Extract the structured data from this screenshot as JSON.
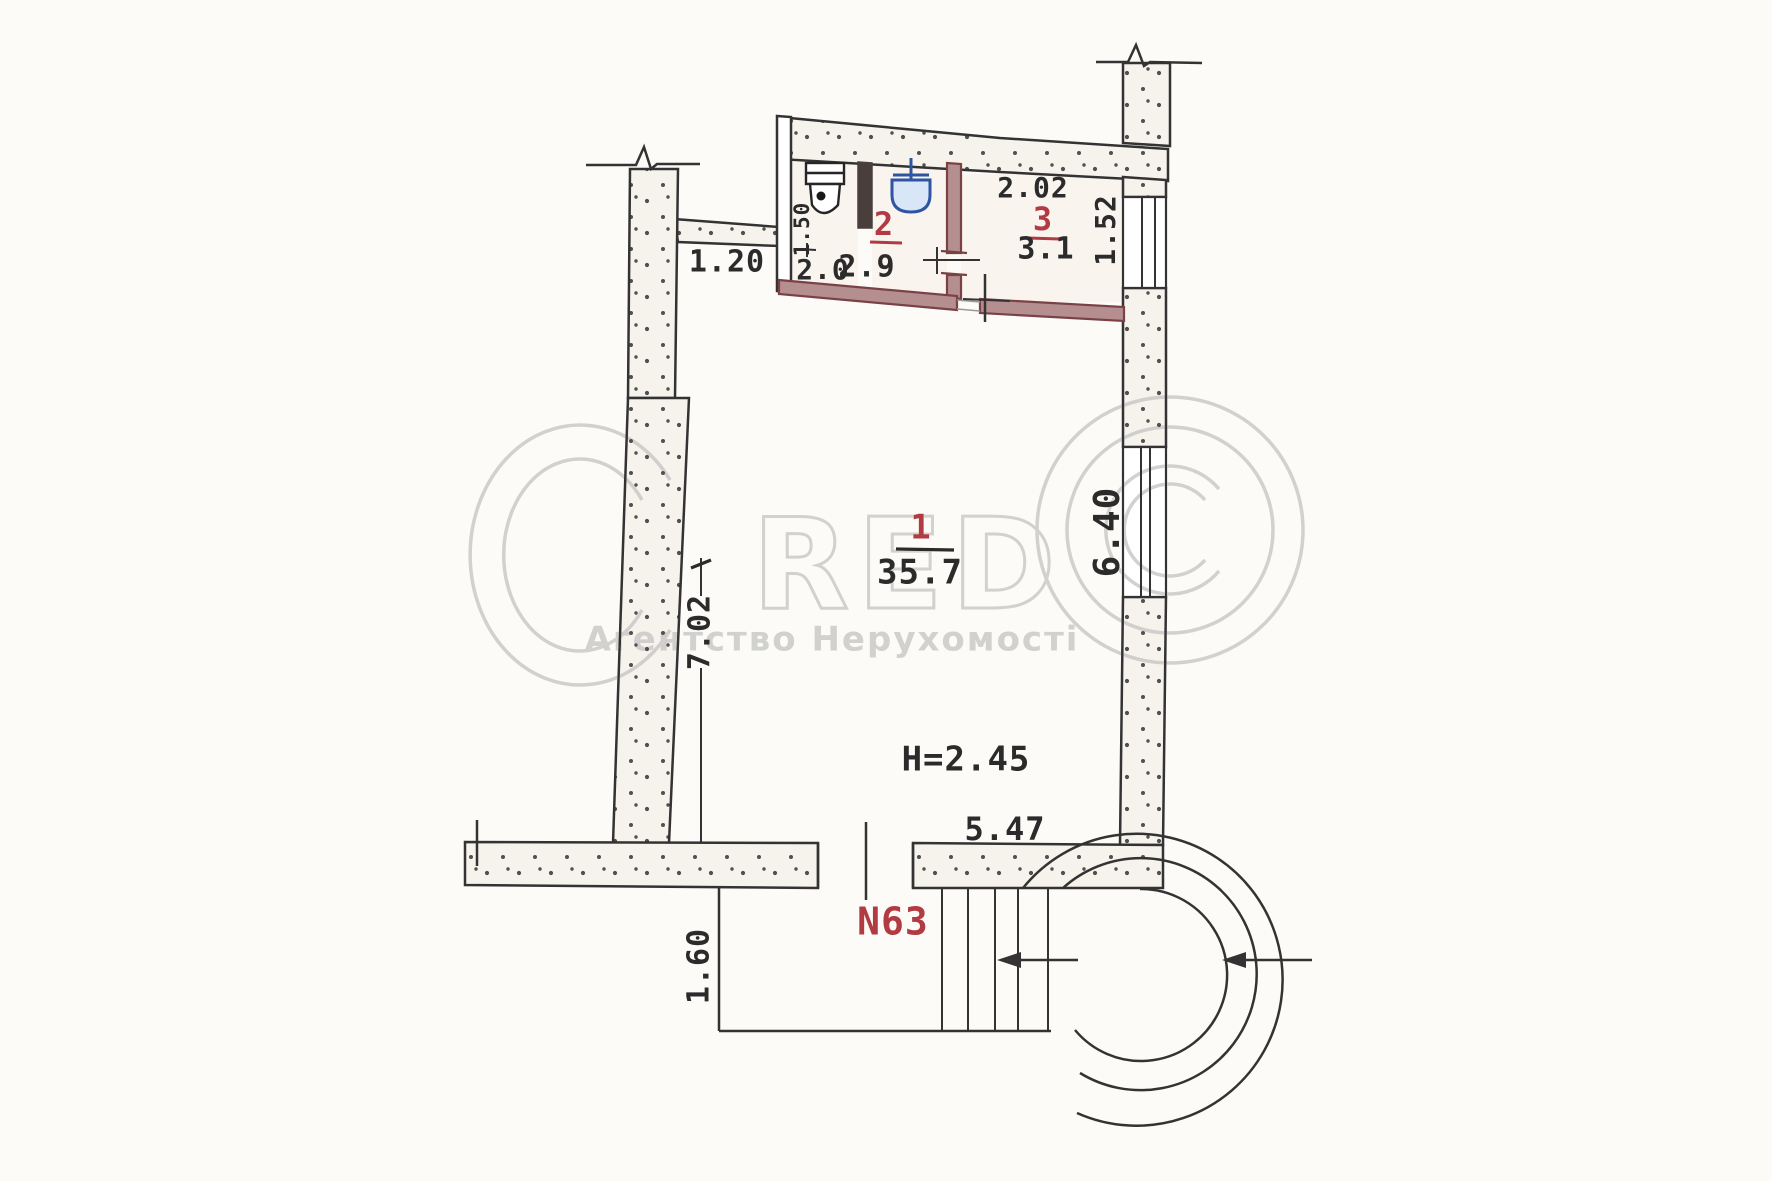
{
  "watermark": {
    "logo_text": "RED",
    "tagline": "Агентство Нерухомості"
  },
  "rooms": [
    {
      "number": "1",
      "area": "35.7"
    },
    {
      "number": "2",
      "area": "2.9"
    },
    {
      "number": "3",
      "area": "3.1"
    }
  ],
  "dimensions": {
    "corridor_width": "1.20",
    "wc_width": "2.0",
    "wc_depth": "1.50",
    "room3_width": "2.02",
    "room3_depth": "1.52",
    "room1_width": "5.47",
    "room1_depth_left": "7.02",
    "room1_depth_right": "6.40",
    "ceiling_height": "H=2.45",
    "porch_depth": "1.60"
  },
  "labels": {
    "unit_number": "N63"
  },
  "colors": {
    "paper": "#fcfbf8",
    "wall-line": "#333333",
    "wall-bg": "#f6f2ec",
    "stipple-dot": "#4f4f4f",
    "masonry-fill": "#b58f8f",
    "masonry-line": "#7a4246",
    "dark-partition": "#4a3e3c",
    "red-label": "#b23a43",
    "fixture-blue": "#2f55a2",
    "fixture-blue-fill": "#d8e6f7",
    "watermark-gray": "#c9c9c9",
    "ink": "#2b2b2b"
  }
}
